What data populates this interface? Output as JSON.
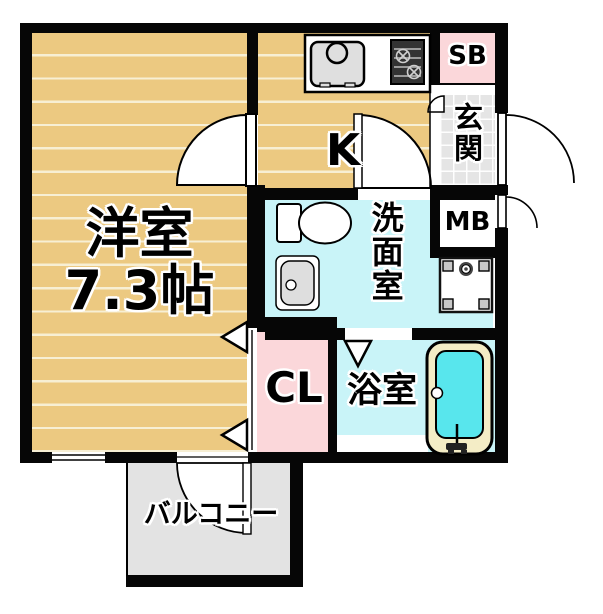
{
  "floor_plan": {
    "rooms": {
      "western_room": {
        "name": "洋室",
        "size": "7.3帖"
      },
      "kitchen": {
        "label": "K"
      },
      "shoe_box": {
        "label": "SB"
      },
      "entrance": {
        "label": "玄関"
      },
      "meter_box": {
        "label": "MB"
      },
      "washroom": {
        "label": "洗面室"
      },
      "closet": {
        "label": "CL"
      },
      "bathroom": {
        "label": "浴室"
      },
      "balcony": {
        "label": "バルコニー"
      }
    },
    "fixtures": {
      "kitchen_sink": "kitchen-sink",
      "stove": "gas-stove",
      "toilet": "toilet",
      "vanity": "vanity-sink",
      "washer_pan": "washing-machine-pan",
      "bathtub": "bathtub"
    },
    "colors": {
      "room_tan": "#ecc981",
      "stripe_cream": "#f7efd4",
      "accent_pink": "#fbd7da",
      "water_cyan": "#c9f4f8",
      "tub_water": "#58e6ed",
      "tub_rim": "#f4edc6",
      "balcony_gray": "#e3e3e3",
      "tile_gray": "#e5e5e5",
      "wall_black": "#060606"
    }
  }
}
